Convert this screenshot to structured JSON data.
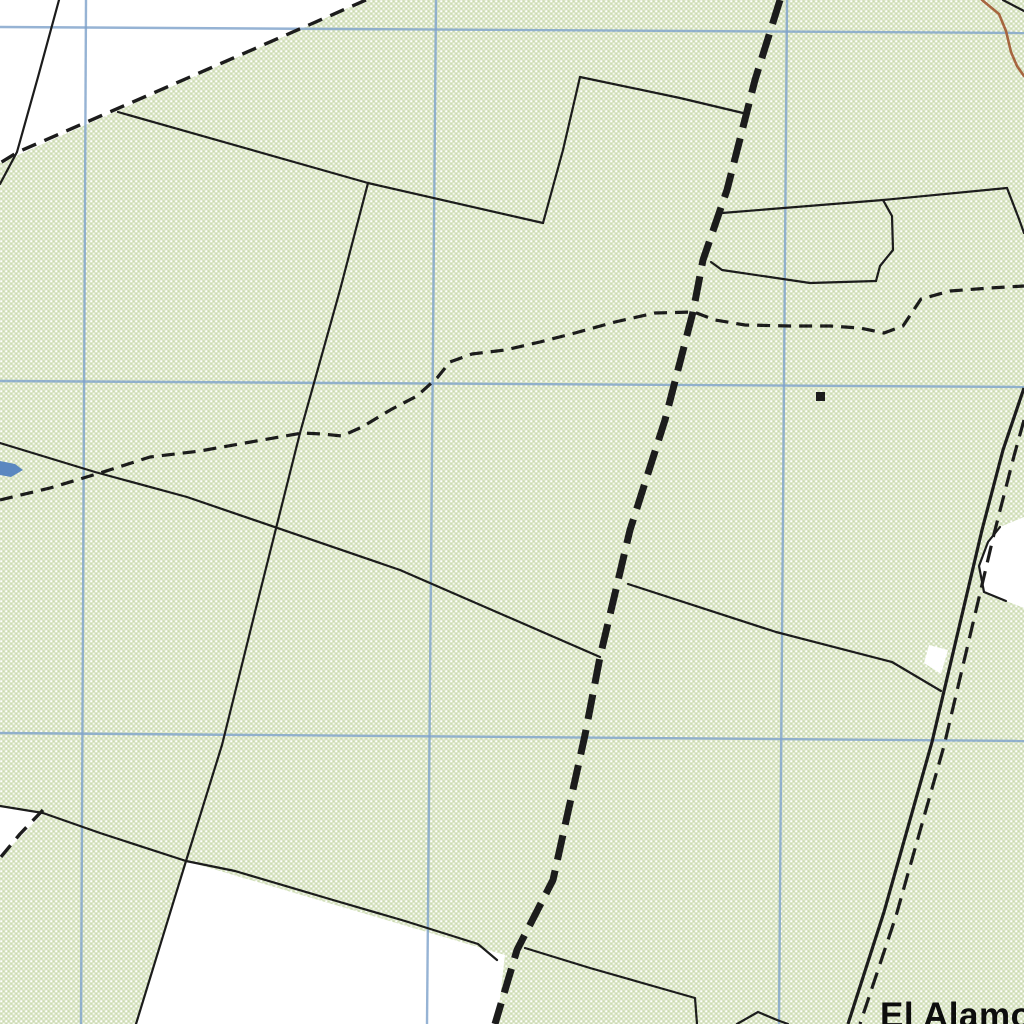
{
  "map": {
    "kind": "scanned-topographic-map-detail",
    "place_label": "El Alamo",
    "colors": {
      "paper": "#ffffff",
      "vegetation_base": "#dbe5c7",
      "vegetation_dot_light": "#ffffff",
      "vegetation_dot_dark": "#c9daae",
      "grid_blue": "#7fa2cb",
      "ink_black": "#1c1c1c",
      "contour_brown": "#a6653f",
      "water_blue": "#5b87c0"
    },
    "features": [
      {
        "name": "clearing-top-left",
        "kind": "polygon",
        "class": "clearing",
        "points": [
          [
            0,
            0
          ],
          [
            366,
            0
          ],
          [
            0,
            163
          ]
        ]
      },
      {
        "name": "clearing-left-wedge",
        "kind": "polygon",
        "class": "clearing",
        "points": [
          [
            0,
            806
          ],
          [
            43,
            813
          ],
          [
            0,
            858
          ]
        ]
      },
      {
        "name": "clearing-bottom-center",
        "kind": "polygon",
        "class": "clearing",
        "points": [
          [
            186,
            861
          ],
          [
            505,
            955
          ],
          [
            497,
            1024
          ],
          [
            136,
            1024
          ]
        ]
      },
      {
        "name": "clearing-roadside",
        "kind": "polygon",
        "class": "clearing",
        "points": [
          [
            1000,
            527
          ],
          [
            1024,
            517
          ],
          [
            1024,
            608
          ],
          [
            1006,
            601
          ],
          [
            984,
            592
          ],
          [
            979,
            566
          ],
          [
            988,
            542
          ]
        ]
      },
      {
        "name": "clearing-road-sliver",
        "kind": "polygon",
        "class": "clearing",
        "points": [
          [
            929,
            645
          ],
          [
            948,
            650
          ],
          [
            941,
            674
          ],
          [
            924,
            663
          ]
        ]
      },
      {
        "name": "grid-line-horizontal-1",
        "kind": "polyline",
        "class": "grid",
        "points": [
          [
            0,
            27
          ],
          [
            1024,
            33
          ]
        ]
      },
      {
        "name": "grid-line-horizontal-2",
        "kind": "polyline",
        "class": "grid",
        "points": [
          [
            0,
            381
          ],
          [
            1024,
            387
          ]
        ]
      },
      {
        "name": "grid-line-horizontal-3",
        "kind": "polyline",
        "class": "grid",
        "points": [
          [
            0,
            733
          ],
          [
            1024,
            741
          ]
        ]
      },
      {
        "name": "grid-line-vertical-1",
        "kind": "polyline",
        "class": "grid",
        "points": [
          [
            86,
            0
          ],
          [
            81,
            1024
          ]
        ]
      },
      {
        "name": "grid-line-vertical-2",
        "kind": "polyline",
        "class": "grid",
        "points": [
          [
            436,
            0
          ],
          [
            427,
            1024
          ]
        ]
      },
      {
        "name": "grid-line-vertical-3",
        "kind": "polyline",
        "class": "grid",
        "points": [
          [
            787,
            0
          ],
          [
            779,
            1024
          ]
        ]
      },
      {
        "name": "water-mark",
        "kind": "polygon",
        "class": "water",
        "points": [
          [
            0,
            461
          ],
          [
            15,
            464
          ],
          [
            23,
            470
          ],
          [
            11,
            477
          ],
          [
            0,
            475
          ]
        ]
      },
      {
        "name": "fence-line-top-left",
        "kind": "polyline",
        "class": "fence",
        "points": [
          [
            59,
            0
          ],
          [
            38,
            77
          ],
          [
            17,
            152
          ],
          [
            0,
            184
          ]
        ]
      },
      {
        "name": "fence-line-upper-long",
        "kind": "polyline",
        "class": "fence",
        "points": [
          [
            118,
            112
          ],
          [
            368,
            183
          ],
          [
            543,
            223
          ]
        ]
      },
      {
        "name": "fence-line-step-vertical",
        "kind": "polyline",
        "class": "fence",
        "points": [
          [
            543,
            223
          ],
          [
            563,
            150
          ],
          [
            580,
            77
          ]
        ]
      },
      {
        "name": "fence-line-step-top",
        "kind": "polyline",
        "class": "fence",
        "points": [
          [
            580,
            77
          ],
          [
            680,
            98
          ],
          [
            743,
            113
          ]
        ]
      },
      {
        "name": "fence-line-west-long",
        "kind": "polyline",
        "class": "fence",
        "points": [
          [
            368,
            183
          ],
          [
            340,
            290
          ],
          [
            300,
            433
          ],
          [
            258,
            600
          ],
          [
            222,
            745
          ],
          [
            186,
            861
          ],
          [
            136,
            1024
          ]
        ]
      },
      {
        "name": "fence-line-mid-long",
        "kind": "polyline",
        "class": "fence",
        "points": [
          [
            0,
            443
          ],
          [
            95,
            472
          ],
          [
            187,
            497
          ],
          [
            400,
            570
          ],
          [
            600,
            657
          ]
        ]
      },
      {
        "name": "fence-line-mid-east",
        "kind": "polyline",
        "class": "fence",
        "points": [
          [
            628,
            584
          ],
          [
            776,
            632
          ],
          [
            892,
            662
          ],
          [
            941,
            691
          ]
        ]
      },
      {
        "name": "fence-line-bottom-long",
        "kind": "polyline",
        "class": "fence",
        "points": [
          [
            0,
            806
          ],
          [
            43,
            813
          ],
          [
            100,
            833
          ],
          [
            186,
            861
          ],
          [
            235,
            871
          ],
          [
            333,
            900
          ],
          [
            405,
            921
          ],
          [
            478,
            944
          ],
          [
            497,
            960
          ]
        ]
      },
      {
        "name": "fence-line-bottom-east",
        "kind": "polyline",
        "class": "fence",
        "points": [
          [
            525,
            948
          ],
          [
            590,
            968
          ],
          [
            660,
            988
          ],
          [
            695,
            998
          ],
          [
            697,
            1024
          ]
        ]
      },
      {
        "name": "fence-line-bottom-notch",
        "kind": "polyline",
        "class": "fence",
        "points": [
          [
            737,
            1024
          ],
          [
            758,
            1012
          ],
          [
            777,
            1020
          ],
          [
            788,
            1024
          ]
        ]
      },
      {
        "name": "fence-line-northeast-long",
        "kind": "polyline",
        "class": "fence",
        "points": [
          [
            722,
            213
          ],
          [
            883,
            200
          ],
          [
            1007,
            188
          ]
        ]
      },
      {
        "name": "fence-line-northeast-corner",
        "kind": "polyline",
        "class": "fence",
        "points": [
          [
            1007,
            188
          ],
          [
            1019,
            219
          ],
          [
            1024,
            233
          ]
        ]
      },
      {
        "name": "fence-line-ne-polygon-east",
        "kind": "polyline",
        "class": "fence",
        "points": [
          [
            883,
            200
          ],
          [
            892,
            216
          ],
          [
            893,
            250
          ],
          [
            880,
            266
          ],
          [
            876,
            281
          ]
        ]
      },
      {
        "name": "fence-line-ne-polygon-south",
        "kind": "polyline",
        "class": "fence",
        "points": [
          [
            876,
            281
          ],
          [
            810,
            283
          ],
          [
            722,
            270
          ],
          [
            711,
            262
          ]
        ]
      },
      {
        "name": "fence-line-clearing-edge",
        "kind": "polyline",
        "class": "fence",
        "points": [
          [
            1000,
            527
          ],
          [
            988,
            542
          ],
          [
            979,
            566
          ],
          [
            984,
            592
          ],
          [
            1006,
            601
          ]
        ]
      },
      {
        "name": "corner-line-top-right",
        "kind": "polyline",
        "class": "fence",
        "points": [
          [
            1003,
            0
          ],
          [
            1024,
            11
          ]
        ]
      },
      {
        "name": "boundary-dashed-top-left",
        "kind": "polyline",
        "class": "dash-md",
        "points": [
          [
            366,
            0
          ],
          [
            190,
            77
          ],
          [
            18,
            152
          ],
          [
            0,
            163
          ]
        ]
      },
      {
        "name": "boundary-dashed-bottom-left",
        "kind": "polyline",
        "class": "dash-md",
        "points": [
          [
            43,
            810
          ],
          [
            20,
            834
          ],
          [
            0,
            858
          ]
        ]
      },
      {
        "name": "trail-dashed-line",
        "kind": "polyline",
        "class": "trail",
        "points": [
          [
            0,
            500
          ],
          [
            50,
            488
          ],
          [
            100,
            473
          ],
          [
            150,
            457
          ],
          [
            200,
            451
          ],
          [
            245,
            443
          ],
          [
            285,
            436
          ],
          [
            302,
            433
          ],
          [
            322,
            434
          ],
          [
            342,
            436
          ],
          [
            362,
            427
          ],
          [
            392,
            409
          ],
          [
            417,
            396
          ],
          [
            437,
            378
          ],
          [
            450,
            362
          ],
          [
            472,
            354
          ],
          [
            505,
            350
          ],
          [
            540,
            342
          ],
          [
            575,
            333
          ],
          [
            615,
            322
          ],
          [
            655,
            313
          ],
          [
            694,
            312
          ],
          [
            715,
            320
          ],
          [
            745,
            325
          ],
          [
            790,
            326
          ],
          [
            830,
            326
          ],
          [
            860,
            328
          ],
          [
            884,
            333
          ],
          [
            903,
            326
          ],
          [
            921,
            299
          ],
          [
            950,
            291
          ],
          [
            990,
            288
          ],
          [
            1024,
            286
          ]
        ]
      },
      {
        "name": "boundary-heavy-dashed-line",
        "kind": "polyline",
        "class": "heavy-dash",
        "points": [
          [
            780,
            0
          ],
          [
            755,
            80
          ],
          [
            727,
            190
          ],
          [
            703,
            260
          ],
          [
            693,
            312
          ],
          [
            665,
            420
          ],
          [
            630,
            530
          ],
          [
            600,
            657
          ],
          [
            585,
            735
          ],
          [
            553,
            880
          ],
          [
            517,
            950
          ],
          [
            495,
            1024
          ]
        ]
      },
      {
        "name": "road-west-edge",
        "kind": "polyline",
        "class": "road-solid",
        "points": [
          [
            1024,
            388
          ],
          [
            1003,
            450
          ],
          [
            982,
            530
          ],
          [
            932,
            742
          ],
          [
            884,
            912
          ],
          [
            848,
            1024
          ]
        ]
      },
      {
        "name": "road-east-edge-dashed",
        "kind": "polyline",
        "class": "road-dash",
        "points": [
          [
            1024,
            420
          ],
          [
            1014,
            456
          ],
          [
            994,
            534
          ],
          [
            944,
            746
          ],
          [
            896,
            916
          ],
          [
            860,
            1024
          ]
        ]
      },
      {
        "name": "contour-line-brown",
        "kind": "polyline",
        "class": "contour",
        "points": [
          [
            982,
            0
          ],
          [
            999,
            14
          ],
          [
            1006,
            31
          ],
          [
            1011,
            52
          ],
          [
            1017,
            66
          ],
          [
            1024,
            76
          ]
        ]
      },
      {
        "name": "building-square",
        "kind": "rect",
        "class": "building",
        "x": 816,
        "y": 392,
        "w": 9,
        "h": 9
      }
    ]
  }
}
